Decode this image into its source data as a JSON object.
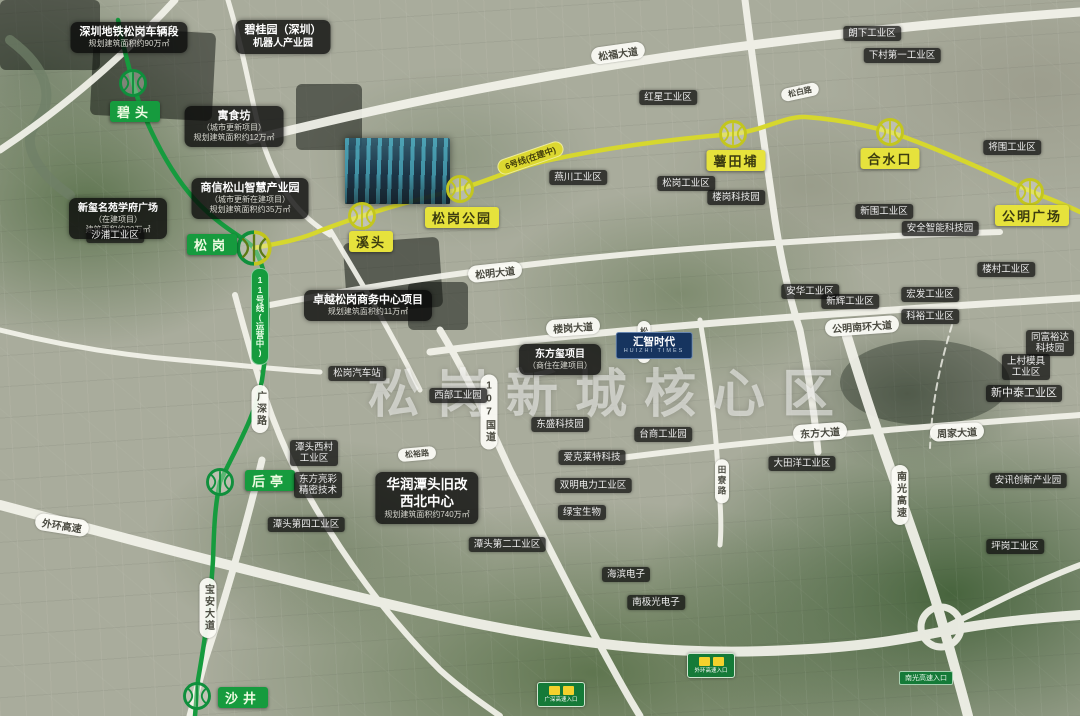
{
  "map": {
    "watermark": "松岗新城核心区",
    "colors": {
      "line11_green": "#169b3e",
      "line6_yellow": "#d6d72e",
      "road_white": "#f4f4ec",
      "label_black": "rgba(14,14,14,0.74)",
      "landmark_blue": "#16345f",
      "sign_green": "#157a38"
    },
    "lines": {
      "line11": {
        "name": "11号线",
        "tag": "11号线(运营中)"
      },
      "line6": {
        "name": "6号线",
        "tag": "6号线(在建中)"
      }
    },
    "stations": [
      {
        "name": "碧头",
        "line": "11"
      },
      {
        "name": "松岗",
        "line": "11/6"
      },
      {
        "name": "溪头",
        "line": "6"
      },
      {
        "name": "松岗公园",
        "line": "6"
      },
      {
        "name": "薯田埔",
        "line": "6"
      },
      {
        "name": "合水口",
        "line": "6"
      },
      {
        "name": "公明广场",
        "line": "6"
      },
      {
        "name": "后亭",
        "line": "11"
      },
      {
        "name": "沙井",
        "line": "11"
      }
    ],
    "roads": {
      "songfu": "松福大道",
      "songming": "松明大道",
      "lougang": "楼岗大道",
      "gmnanhuan": "公明南环大道",
      "dongfang": "东方大道",
      "zhoujia": "周家大道",
      "waihuan": "外环高速",
      "g107": "107国道",
      "guangshen": "广深路",
      "baoan": "宝安大道",
      "nanguang": "南光高速",
      "tianliao": "田寮路",
      "songrui": "松瑞路",
      "songbai": "松白路",
      "songyu": "松裕路"
    },
    "projects": [
      {
        "lines": [
          "深圳地铁松岗车辆段",
          "规划建筑面积约90万㎡"
        ]
      },
      {
        "lines": [
          "碧桂园（深圳）",
          "机器人产业园"
        ]
      },
      {
        "lines": [
          "寓食坊",
          "（城市更新项目）",
          "规划建筑面积约12万㎡"
        ]
      },
      {
        "lines": [
          "商信松山智慧产业园",
          "（城市更新在建项目）",
          "规划建筑面积约35万㎡"
        ]
      },
      {
        "lines": [
          "新玺名苑学府广场",
          "（在建项目）",
          "建筑面积约20万㎡"
        ]
      },
      {
        "lines": [
          "卓越松岗商务中心项目",
          "规划建筑面积约11万㎡"
        ]
      },
      {
        "lines": [
          "华润潭头旧改",
          "西北中心",
          "规划建筑面积约740万㎡"
        ]
      },
      {
        "lines": [
          "东方玺项目",
          "（商住在建项目）"
        ]
      }
    ],
    "landmark": {
      "name": "汇智时代",
      "sub": "HUIZHI TIMES"
    },
    "areas": [
      {
        "lines": [
          "红星工业区"
        ]
      },
      {
        "lines": [
          "朗下工业区"
        ]
      },
      {
        "lines": [
          "下村第一工业区"
        ]
      },
      {
        "lines": [
          "将围工业区"
        ]
      },
      {
        "lines": [
          "燕川工业区"
        ]
      },
      {
        "lines": [
          "松岗工业区"
        ]
      },
      {
        "lines": [
          "楼岗科技园"
        ]
      },
      {
        "lines": [
          "新围工业区"
        ]
      },
      {
        "lines": [
          "安全智能科技园"
        ]
      },
      {
        "lines": [
          "楼村工业区"
        ]
      },
      {
        "lines": [
          "安华工业区"
        ]
      },
      {
        "lines": [
          "新辉工业区"
        ]
      },
      {
        "lines": [
          "宏发工业区"
        ]
      },
      {
        "lines": [
          "科裕工业区"
        ]
      },
      {
        "lines": [
          "同富裕达",
          "科技园"
        ]
      },
      {
        "lines": [
          "上村模具",
          "工业区"
        ]
      },
      {
        "lines": [
          "新中泰工业区"
        ]
      },
      {
        "lines": [
          "西部工业园"
        ]
      },
      {
        "lines": [
          "松岗汽车站"
        ]
      },
      {
        "lines": [
          "沙浦工业区"
        ]
      },
      {
        "lines": [
          "台商工业园"
        ]
      },
      {
        "lines": [
          "东盛科技园"
        ]
      },
      {
        "lines": [
          "爱克莱特科技"
        ]
      },
      {
        "lines": [
          "双明电力工业区"
        ]
      },
      {
        "lines": [
          "绿宝生物"
        ]
      },
      {
        "lines": [
          "潭头第二工业区"
        ]
      },
      {
        "lines": [
          "潭头第四工业区"
        ]
      },
      {
        "lines": [
          "潭头西村",
          "工业区"
        ]
      },
      {
        "lines": [
          "东方亮彩",
          "精密技术"
        ]
      },
      {
        "lines": [
          "海滨电子"
        ]
      },
      {
        "lines": [
          "南极光电子"
        ]
      },
      {
        "lines": [
          "大田洋工业区"
        ]
      },
      {
        "lines": [
          "安讯创新产业园"
        ]
      },
      {
        "lines": [
          "坪岗工业区"
        ]
      }
    ],
    "signs": [
      {
        "text": "广深高速入口"
      },
      {
        "text": "外环高速入口"
      },
      {
        "text": "南光高速入口"
      }
    ]
  }
}
